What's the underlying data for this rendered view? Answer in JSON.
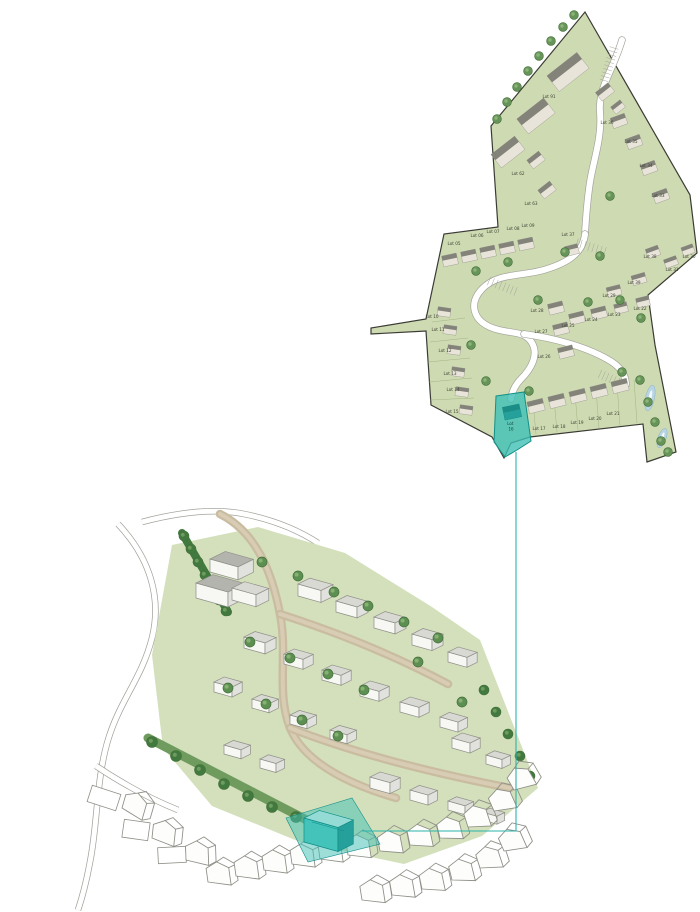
{
  "palette": {
    "plan_green": "#cedbb2",
    "plan_green_dark": "#b9cc94",
    "boundary": "#3b3b35",
    "road_white": "#ffffff",
    "road_edge": "#a3a39b",
    "division": "#9fae80",
    "house_fill": "#e9e4d9",
    "house_roof": "#83837a",
    "tree_green": "#679459",
    "tree_dark": "#44703a",
    "water": "#b9d5e3",
    "water_edge": "#8fb3c9",
    "teal": "#3fc0b5",
    "teal_dark": "#128f88",
    "teal_side": "#26a09a",
    "teal_roof": "#93dbd4",
    "connector": "#2bb3ab",
    "iso_green": "#d3e0bb",
    "iso_road": "#c9bca0",
    "iso_road_core": "#d8cdb4",
    "hedge": "#41793f",
    "hedge_light": "#6f9b5e",
    "iso_house_front": "#f7f7f4",
    "iso_house_side": "#e1e1dd",
    "iso_house_roof": "#d9d9d4",
    "iso_gray_roof": "#b4b4ae",
    "outline": "#8f8f88",
    "label": "#3f4036"
  },
  "plan_view": {
    "highlight": {
      "label_line1": "Lot",
      "label_line2": "16"
    },
    "lots": [
      {
        "label": "Lot 91",
        "x": 549,
        "y": 98
      },
      {
        "label": "Lot 36",
        "x": 607,
        "y": 124
      },
      {
        "label": "Lot 35",
        "x": 631,
        "y": 143
      },
      {
        "label": "Lot 34",
        "x": 646,
        "y": 167
      },
      {
        "label": "Lot 33",
        "x": 658,
        "y": 197
      },
      {
        "label": "Lot 62",
        "x": 518,
        "y": 175
      },
      {
        "label": "Lot 63",
        "x": 531,
        "y": 205
      },
      {
        "label": "Lot 37",
        "x": 568,
        "y": 236
      },
      {
        "label": "Lot 38",
        "x": 650,
        "y": 258
      },
      {
        "label": "Lot 39",
        "x": 634,
        "y": 284
      },
      {
        "label": "Lot 31",
        "x": 672,
        "y": 271
      },
      {
        "label": "Lot 30",
        "x": 689,
        "y": 258
      },
      {
        "label": "Lot 29",
        "x": 609,
        "y": 297
      },
      {
        "label": "Lot 28",
        "x": 537,
        "y": 312
      },
      {
        "label": "Lot 27",
        "x": 541,
        "y": 333
      },
      {
        "label": "Lot 26",
        "x": 544,
        "y": 358
      },
      {
        "label": "Lot 25",
        "x": 568,
        "y": 327
      },
      {
        "label": "Lot 24",
        "x": 591,
        "y": 321
      },
      {
        "label": "Lot 23",
        "x": 614,
        "y": 316
      },
      {
        "label": "Lot 22",
        "x": 640,
        "y": 310
      },
      {
        "label": "Lot 05",
        "x": 454,
        "y": 245
      },
      {
        "label": "Lot 06",
        "x": 477,
        "y": 237
      },
      {
        "label": "Lot 07",
        "x": 493,
        "y": 233
      },
      {
        "label": "Lot 08",
        "x": 513,
        "y": 230
      },
      {
        "label": "Lot 09",
        "x": 528,
        "y": 227
      },
      {
        "label": "Lot 10",
        "x": 432,
        "y": 318
      },
      {
        "label": "Lot 11",
        "x": 438,
        "y": 331
      },
      {
        "label": "Lot 12",
        "x": 445,
        "y": 352
      },
      {
        "label": "Lot 13",
        "x": 450,
        "y": 375
      },
      {
        "label": "Lot 14",
        "x": 453,
        "y": 391
      },
      {
        "label": "Lot 15",
        "x": 452,
        "y": 413
      },
      {
        "label": "Lot 17",
        "x": 539,
        "y": 430
      },
      {
        "label": "Lot 18",
        "x": 559,
        "y": 428
      },
      {
        "label": "Lot 19",
        "x": 577,
        "y": 424
      },
      {
        "label": "Lot 20",
        "x": 595,
        "y": 420
      },
      {
        "label": "Lot 21",
        "x": 613,
        "y": 415
      }
    ]
  }
}
